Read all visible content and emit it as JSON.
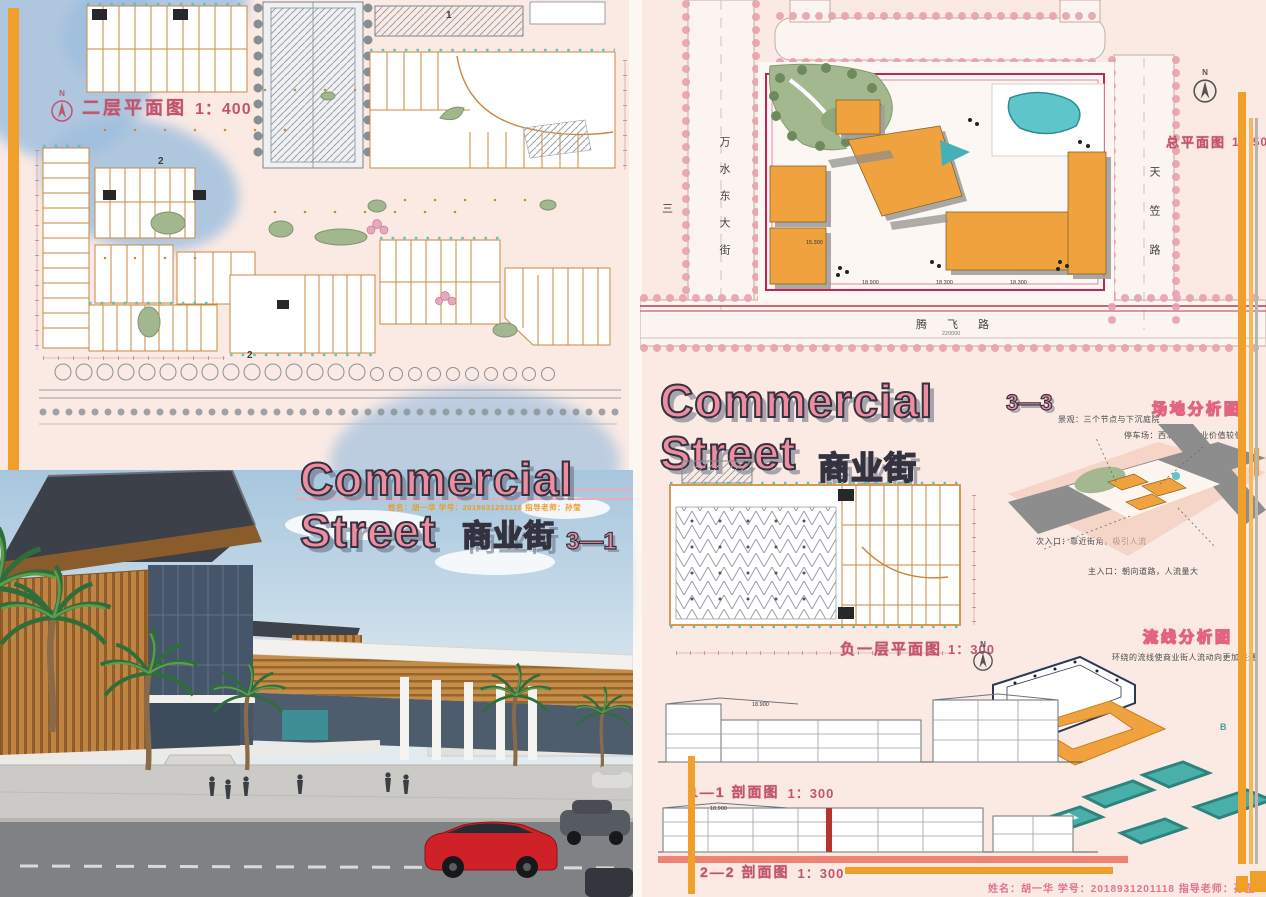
{
  "credit": {
    "text": "姓名：胡一华    学号：2018931201118    指导老师：孙莹"
  },
  "left_panel": {
    "plan_label": {
      "north": "N",
      "title": "二层平面图",
      "scale": "1：400"
    },
    "markers": {
      "m1": "1",
      "m2": "2",
      "m2b": "2"
    },
    "title": {
      "line1": "Commercial",
      "line2": "Street",
      "cn": "商业街",
      "num": "3—1"
    }
  },
  "right_panel": {
    "site": {
      "north": "N",
      "title": "总平面图",
      "scale": "1：500",
      "road_west": "万水东大街",
      "road_east": "天笠路",
      "road_south": "腾飞路",
      "road_edge": "三",
      "dim_south": "220000",
      "spots": [
        "18.900",
        "18.300",
        "18.300",
        "15.300"
      ]
    },
    "title": {
      "line1": "Commercial",
      "num": "3—3",
      "line2": "Street",
      "cn": "商业街"
    },
    "site_analysis": {
      "title": "场地分析图",
      "notes": [
        "景观：三个节点与下沉庭院",
        "停车场：西北角，商业价值较低",
        "次入口：靠近街角，吸引人流",
        "主入口：朝向道路，人流量大"
      ]
    },
    "basement": {
      "title": "负一层平面图",
      "scale": "1：300",
      "north": "N"
    },
    "circulation": {
      "title": "流线分析图",
      "caption": "环绕的流线使商业街人流动向更加联通",
      "marker": "B"
    },
    "sections": [
      {
        "title": "1—1 剖面图",
        "scale": "1：300",
        "spot": "18.900"
      },
      {
        "title": "2—2 剖面图",
        "scale": "1：300",
        "spot": "18.900"
      }
    ]
  }
}
